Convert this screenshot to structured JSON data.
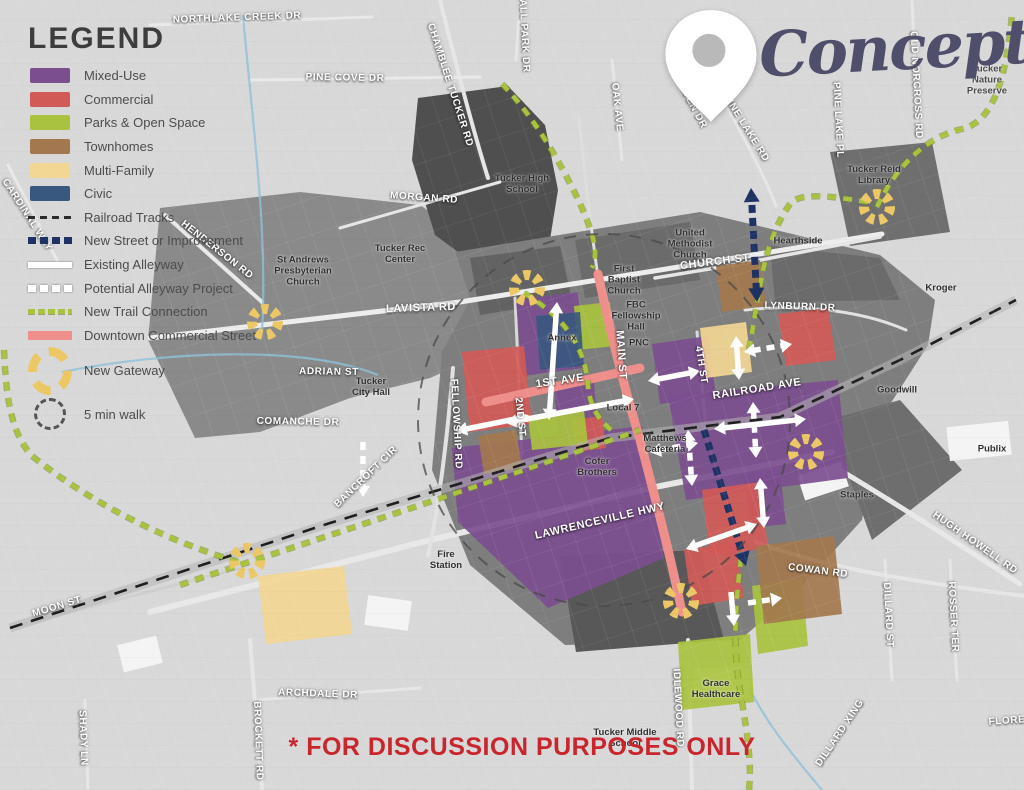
{
  "title": {
    "text": "Concept 1"
  },
  "disclaimer": {
    "text": "* FOR DISCUSSION PURPOSES ONLY",
    "color": "#C9252D"
  },
  "legend": {
    "heading": "LEGEND",
    "items": [
      {
        "label": "Mixed-Use",
        "type": "swatch",
        "color": "#7B4E8F"
      },
      {
        "label": "Commercial",
        "type": "swatch",
        "color": "#D15A57"
      },
      {
        "label": "Parks & Open Space",
        "type": "swatch",
        "color": "#A9C23F"
      },
      {
        "label": "Townhomes",
        "type": "swatch",
        "color": "#A3784E"
      },
      {
        "label": "Multi-Family",
        "type": "swatch",
        "color": "#F2D694"
      },
      {
        "label": "Civic",
        "type": "swatch",
        "color": "#39587F"
      },
      {
        "label": "Railroad Tracks",
        "type": "rail",
        "color": "#2b2b2b"
      },
      {
        "label": "New Street or Improvement",
        "type": "navy",
        "color": "#1E3264"
      },
      {
        "label": "Existing Alleyway",
        "type": "wsolid",
        "color": "#FFFFFF"
      },
      {
        "label": "Potential Alleyway Project",
        "type": "wdash",
        "color": "#FFFFFF"
      },
      {
        "label": "New Trail Connection",
        "type": "trail",
        "color": "#A9C23F"
      },
      {
        "label": "Downtown Commercial Street",
        "type": "pink",
        "color": "#EF8F8C"
      },
      {
        "label": "New Gateway",
        "type": "gateway",
        "color": "#ECC765"
      },
      {
        "label": "5 min walk",
        "type": "walk",
        "color": "#555555"
      }
    ]
  },
  "map": {
    "zone_colors": {
      "mixed-use": "#7B4E8F",
      "commercial": "#D15A57",
      "parks-open-space": "#A9C23F",
      "townhomes": "#A3784E",
      "multi-family": "#F2D694",
      "civic": "#39587F"
    },
    "zones": [
      {
        "category": "mixed-use",
        "points": "516,300 578,292 584,368 522,376"
      },
      {
        "category": "mixed-use",
        "points": "554,386 594,382 598,436 558,440"
      },
      {
        "category": "mixed-use",
        "points": "652,344 708,336 716,396 660,404"
      },
      {
        "category": "mixed-use",
        "points": "668,396 838,380 848,478 686,500"
      },
      {
        "category": "mixed-use",
        "points": "452,448 642,426 664,558 548,608 458,522"
      },
      {
        "category": "mixed-use",
        "points": "744,474 780,470 786,524 750,528"
      },
      {
        "category": "commercial",
        "points": "462,352 524,346 532,424 470,432"
      },
      {
        "category": "commercial",
        "points": "572,420 602,416 606,448 576,452"
      },
      {
        "category": "commercial",
        "points": "778,314 828,308 836,360 786,366"
      },
      {
        "category": "commercial",
        "points": "702,490 760,482 768,548 710,556"
      },
      {
        "category": "commercial",
        "points": "684,550 736,542 744,598 692,606"
      },
      {
        "category": "parks-open-space",
        "points": "574,306 610,302 614,346 578,350"
      },
      {
        "category": "parks-open-space",
        "points": "528,416 584,410 588,444 532,450"
      },
      {
        "category": "parks-open-space",
        "points": "678,642 750,634 754,702 682,710"
      },
      {
        "category": "parks-open-space",
        "points": "752,586 802,578 808,646 758,654"
      },
      {
        "category": "townhomes",
        "points": "716,266 760,260 766,306 722,312"
      },
      {
        "category": "townhomes",
        "points": "478,436 516,430 522,468 484,474"
      },
      {
        "category": "townhomes",
        "points": "756,546 834,536 842,614 764,624"
      },
      {
        "category": "multi-family",
        "points": "700,328 746,322 752,372 706,378"
      },
      {
        "category": "multi-family",
        "points": "258,576 344,566 352,634 266,644"
      },
      {
        "category": "civic",
        "points": "536,316 580,312 584,366 540,370"
      }
    ],
    "dark_areas": [
      {
        "points": "160,208 300,192 420,205 470,240 540,262 555,300 520,345 470,360 430,378 350,398 260,432 195,438 148,340",
        "fill": "#8a8a8a"
      },
      {
        "points": "418,98 508,86 545,125 558,190 548,252 480,268 435,235 412,160",
        "fill": "#4f4f4f"
      },
      {
        "points": "455,252 700,212 880,255 935,300 928,345 880,420 862,520 800,588 740,640 565,645 470,565 432,470 442,352 470,300",
        "fill": "#7e7e7e"
      },
      {
        "points": "470,258 560,246 572,300 480,315",
        "fill": "#636363"
      },
      {
        "points": "575,240 690,222 700,280 585,298",
        "fill": "#6b6b6b"
      },
      {
        "points": "770,246 880,258 900,300 775,302",
        "fill": "#6b6b6b"
      },
      {
        "points": "830,152 932,142 950,232 850,246",
        "fill": "#6f6f6f"
      },
      {
        "points": "828,420 900,400 962,470 872,540",
        "fill": "#6e6e6e"
      },
      {
        "points": "560,556 700,550 724,640 576,652",
        "fill": "#585858"
      }
    ],
    "buildings": [
      {
        "x": 948,
        "y": 424,
        "w": 62,
        "h": 34,
        "rot": -6
      },
      {
        "x": 694,
        "y": 668,
        "w": 56,
        "h": 30,
        "rot": 0
      },
      {
        "x": 800,
        "y": 468,
        "w": 46,
        "h": 26,
        "rot": -18
      },
      {
        "x": 366,
        "y": 598,
        "w": 44,
        "h": 30,
        "rot": 8
      },
      {
        "x": 120,
        "y": 640,
        "w": 40,
        "h": 28,
        "rot": -14
      }
    ],
    "roads": [
      {
        "d": "M150,338 L460,302 L660,270 L882,234",
        "w": 5,
        "c": "#ededed"
      },
      {
        "d": "M655,278 L745,263 L880,237",
        "w": 3.5,
        "c": "#e6e6e6"
      },
      {
        "d": "M150,612 L430,540 L660,486 L832,452",
        "w": 6,
        "c": "#e8e8e8"
      },
      {
        "d": "M840,470 C900,506 962,546 1020,584",
        "w": 5,
        "c": "#e8e8e8"
      },
      {
        "d": "M756,542 C820,566 900,580 1024,596",
        "w": 4,
        "c": "#e6e6e6"
      },
      {
        "d": "M250,640 L262,790",
        "w": 4,
        "c": "#e6e6e6"
      },
      {
        "d": "M688,640 L692,790",
        "w": 4,
        "c": "#e6e6e6"
      },
      {
        "d": "M340,228 L500,182",
        "w": 3,
        "c": "#e6e6e6"
      },
      {
        "d": "M597,270 C590,220 584,170 579,118",
        "w": 3,
        "c": "#dedede"
      },
      {
        "d": "M697,332 L706,428",
        "w": 3,
        "c": "#d8d8d8"
      },
      {
        "d": "M515,298 L522,455",
        "w": 3,
        "c": "#d8d8d8"
      },
      {
        "d": "M453,368 C448,430 440,500 428,556",
        "w": 4,
        "c": "#e2e2e2"
      },
      {
        "d": "M440,0 C455,60 470,120 488,178",
        "w": 4,
        "c": "#e6e6e6"
      },
      {
        "d": "M612,60 L622,160",
        "w": 3,
        "c": "#e6e6e6"
      },
      {
        "d": "M702,62 C740,130 762,170 776,206",
        "w": 3,
        "c": "#e6e6e6"
      },
      {
        "d": "M912,0 L918,140",
        "w": 3,
        "c": "#e6e6e6"
      },
      {
        "d": "M745,310 C800,304 860,310 906,330",
        "w": 3,
        "c": "#e2e2e2"
      },
      {
        "d": "M255,700 L420,688",
        "w": 3,
        "c": "#e6e6e6"
      },
      {
        "d": "M85,700 L88,790",
        "w": 3,
        "c": "#e6e6e6"
      },
      {
        "d": "M885,560 L892,680",
        "w": 3,
        "c": "#e6e6e6"
      },
      {
        "d": "M950,560 L957,680",
        "w": 3,
        "c": "#e6e6e6"
      },
      {
        "d": "M150,25 L372,17",
        "w": 3,
        "c": "#e9e9e9"
      },
      {
        "d": "M250,80 L480,77",
        "w": 3,
        "c": "#e9e9e9"
      },
      {
        "d": "M165,215 L262,302",
        "w": 4,
        "c": "#e9e9e9"
      },
      {
        "d": "M8,165 L58,262",
        "w": 3,
        "c": "#e9e9e9"
      },
      {
        "d": "M20,625 L240,568",
        "w": 3,
        "c": "#cfcfcf"
      },
      {
        "d": "M520,0 L516,60",
        "w": 3,
        "c": "#e6e6e6"
      }
    ],
    "creeks": [
      "M243,15 C252,120 268,230 262,332",
      "M62,372 C162,352 300,344 378,375",
      "M742,672 C760,716 790,752 822,790"
    ],
    "railroad": {
      "d": "M10,628 L330,523 L610,438 L780,417 L900,360 L1016,300"
    },
    "pink_streets": [
      "M598,274 C610,330 622,380 640,440 C655,498 668,545 682,612",
      "M486,402 L640,368"
    ],
    "trails": [
      "M502,84 C530,112 562,162 585,215 C595,240 598,255 592,268",
      "M180,585 C300,545 480,486 640,430",
      "M524,293 C560,315 585,342 588,386 C590,408 600,422 614,432",
      "M868,202 C830,196 800,192 790,204 C780,218 768,242 762,276 C757,300 753,330 748,354",
      "M877,207 C898,162 930,136 962,129 C992,122 1006,82 1012,14",
      "M741,558 C736,600 732,642 740,690 C747,732 752,762 749,790",
      "M4,350 C6,394 10,432 32,456 C82,496 152,536 238,562"
    ],
    "new_streets": [
      {
        "x1": 757,
        "y1": 302,
        "x2": 751,
        "y2": 188,
        "heads": 2
      },
      {
        "x1": 704,
        "y1": 430,
        "x2": 746,
        "y2": 566,
        "heads": 1
      }
    ],
    "arrows": [
      {
        "x1": 557,
        "y1": 302,
        "x2": 549,
        "y2": 420,
        "style": "solid",
        "heads": 2
      },
      {
        "x1": 506,
        "y1": 423,
        "x2": 634,
        "y2": 399,
        "style": "solid",
        "heads": 2
      },
      {
        "x1": 363,
        "y1": 442,
        "x2": 363,
        "y2": 497,
        "style": "dash",
        "heads": 1
      },
      {
        "x1": 456,
        "y1": 431,
        "x2": 530,
        "y2": 416,
        "style": "solid",
        "heads": 2
      },
      {
        "x1": 648,
        "y1": 381,
        "x2": 700,
        "y2": 371,
        "style": "solid",
        "heads": 2
      },
      {
        "x1": 736,
        "y1": 336,
        "x2": 739,
        "y2": 380,
        "style": "solid",
        "heads": 2
      },
      {
        "x1": 744,
        "y1": 352,
        "x2": 792,
        "y2": 344,
        "style": "dash",
        "heads": 2
      },
      {
        "x1": 753,
        "y1": 402,
        "x2": 756,
        "y2": 458,
        "style": "dash",
        "heads": 2
      },
      {
        "x1": 714,
        "y1": 429,
        "x2": 806,
        "y2": 419,
        "style": "solid",
        "heads": 2
      },
      {
        "x1": 688,
        "y1": 430,
        "x2": 692,
        "y2": 486,
        "style": "dash",
        "heads": 2
      },
      {
        "x1": 650,
        "y1": 452,
        "x2": 698,
        "y2": 443,
        "style": "dash",
        "heads": 2
      },
      {
        "x1": 760,
        "y1": 478,
        "x2": 764,
        "y2": 528,
        "style": "solid",
        "heads": 2
      },
      {
        "x1": 686,
        "y1": 549,
        "x2": 757,
        "y2": 524,
        "style": "solid",
        "heads": 2
      },
      {
        "x1": 748,
        "y1": 603,
        "x2": 782,
        "y2": 598,
        "style": "dash",
        "heads": 1
      },
      {
        "x1": 731,
        "y1": 592,
        "x2": 734,
        "y2": 626,
        "style": "solid",
        "heads": 1
      }
    ],
    "walk_circle": {
      "cx": 604,
      "cy": 420,
      "r": 186
    },
    "gateways": [
      {
        "x": 527,
        "y": 288
      },
      {
        "x": 265,
        "y": 322
      },
      {
        "x": 877,
        "y": 207
      },
      {
        "x": 806,
        "y": 452
      },
      {
        "x": 247,
        "y": 561
      },
      {
        "x": 681,
        "y": 601
      }
    ],
    "street_labels": [
      {
        "text": "NORTHLAKE CREEK DR",
        "x": 237,
        "y": 18,
        "r": -2
      },
      {
        "text": "PINE COVE DR",
        "x": 345,
        "y": 78,
        "r": 1
      },
      {
        "text": "CHAMBLEE TUCKER RD",
        "x": 450,
        "y": 85,
        "r": 72
      },
      {
        "text": "BALL PARK DR",
        "x": 524,
        "y": 32,
        "r": 87
      },
      {
        "text": "MORGAN RD",
        "x": 424,
        "y": 198,
        "r": 4
      },
      {
        "text": "OAK AVE",
        "x": 617,
        "y": 107,
        "r": 84
      },
      {
        "text": "HAVEN DR",
        "x": 691,
        "y": 103,
        "r": 62
      },
      {
        "text": "PINE LAKE RD",
        "x": 746,
        "y": 128,
        "r": 58
      },
      {
        "text": "PINE LAKE PL",
        "x": 838,
        "y": 120,
        "r": 87
      },
      {
        "text": "OLD NORCROSS RD",
        "x": 916,
        "y": 85,
        "r": 87
      },
      {
        "text": "CARDINAL WAY",
        "x": 27,
        "y": 215,
        "r": 57
      },
      {
        "text": "HENDERSON RD",
        "x": 217,
        "y": 250,
        "r": 38
      },
      {
        "text": "LAVISTA RD",
        "x": 421,
        "y": 308,
        "r": -2,
        "s": 11
      },
      {
        "text": "CHURCH ST",
        "x": 715,
        "y": 262,
        "r": -7,
        "s": 11
      },
      {
        "text": "LYNBURN DR",
        "x": 800,
        "y": 307,
        "r": 2
      },
      {
        "text": "ADRIAN ST",
        "x": 329,
        "y": 372,
        "r": 1
      },
      {
        "text": "COMANCHE DR",
        "x": 298,
        "y": 422,
        "r": 1
      },
      {
        "text": "FELLOWSHIP RD",
        "x": 456,
        "y": 424,
        "r": 87
      },
      {
        "text": "BANCROFT CIR",
        "x": 366,
        "y": 477,
        "r": -44
      },
      {
        "text": "1ST AVE",
        "x": 560,
        "y": 381,
        "r": -8,
        "s": 11
      },
      {
        "text": "MAIN ST",
        "x": 621,
        "y": 355,
        "r": 86,
        "s": 11
      },
      {
        "text": "2ND ST",
        "x": 520,
        "y": 417,
        "r": 84
      },
      {
        "text": "4TH ST",
        "x": 701,
        "y": 365,
        "r": 81
      },
      {
        "text": "RAILROAD AVE",
        "x": 757,
        "y": 389,
        "r": -9,
        "s": 11
      },
      {
        "text": "LAWRENCEVILLE HWY",
        "x": 600,
        "y": 521,
        "r": -13,
        "s": 11
      },
      {
        "text": "COWAN RD",
        "x": 818,
        "y": 571,
        "r": 7
      },
      {
        "text": "MOON ST",
        "x": 57,
        "y": 607,
        "r": -17
      },
      {
        "text": "SHADY LN",
        "x": 83,
        "y": 738,
        "r": 88
      },
      {
        "text": "BROCKETT RD",
        "x": 258,
        "y": 741,
        "r": 88
      },
      {
        "text": "ARCHDALE DR",
        "x": 318,
        "y": 694,
        "r": 2
      },
      {
        "text": "IDLEWOOD RD",
        "x": 678,
        "y": 708,
        "r": 87
      },
      {
        "text": "DILLARD ST",
        "x": 888,
        "y": 615,
        "r": 87
      },
      {
        "text": "ROSSER TER",
        "x": 953,
        "y": 617,
        "r": 87
      },
      {
        "text": "HUGH HOWELL RD",
        "x": 975,
        "y": 543,
        "r": 35
      },
      {
        "text": "DILLARD XING",
        "x": 840,
        "y": 733,
        "r": -56
      },
      {
        "text": "FLORE",
        "x": 1007,
        "y": 721,
        "r": -4
      }
    ],
    "place_labels": [
      {
        "text": "Tucker High\nSchool",
        "x": 522,
        "y": 185
      },
      {
        "text": "Tucker Rec\nCenter",
        "x": 400,
        "y": 255
      },
      {
        "text": "St Andrews\nPresbyterian\nChurch",
        "x": 303,
        "y": 272
      },
      {
        "text": "United\nMethodist\nChurch",
        "x": 690,
        "y": 245
      },
      {
        "text": "First\nBaptist\nChurch",
        "x": 624,
        "y": 281
      },
      {
        "text": "FBC\nFellowship\nHall",
        "x": 636,
        "y": 317
      },
      {
        "text": "PNC",
        "x": 639,
        "y": 344
      },
      {
        "text": "Hearthside",
        "x": 798,
        "y": 242
      },
      {
        "text": "Tucker Reid\nLibrary",
        "x": 874,
        "y": 176
      },
      {
        "text": "Annex",
        "x": 562,
        "y": 339
      },
      {
        "text": "Tucker\nCity Hall",
        "x": 371,
        "y": 388
      },
      {
        "text": "Local 7",
        "x": 623,
        "y": 409
      },
      {
        "text": "Cofer\nBrothers",
        "x": 597,
        "y": 468
      },
      {
        "text": "Matthews\nCafeteria",
        "x": 665,
        "y": 445
      },
      {
        "text": "Fire\nStation",
        "x": 446,
        "y": 561
      },
      {
        "text": "Grace\nHealthcare",
        "x": 716,
        "y": 690
      },
      {
        "text": "Tucker Middle\nSchool",
        "x": 625,
        "y": 739
      },
      {
        "text": "Kroger",
        "x": 941,
        "y": 289
      },
      {
        "text": "Goodwill",
        "x": 897,
        "y": 391
      },
      {
        "text": "Publix",
        "x": 992,
        "y": 450
      },
      {
        "text": "Staples",
        "x": 857,
        "y": 496
      },
      {
        "text": "Tucker Nature\nPreserve",
        "x": 987,
        "y": 81,
        "lt": true
      }
    ]
  }
}
